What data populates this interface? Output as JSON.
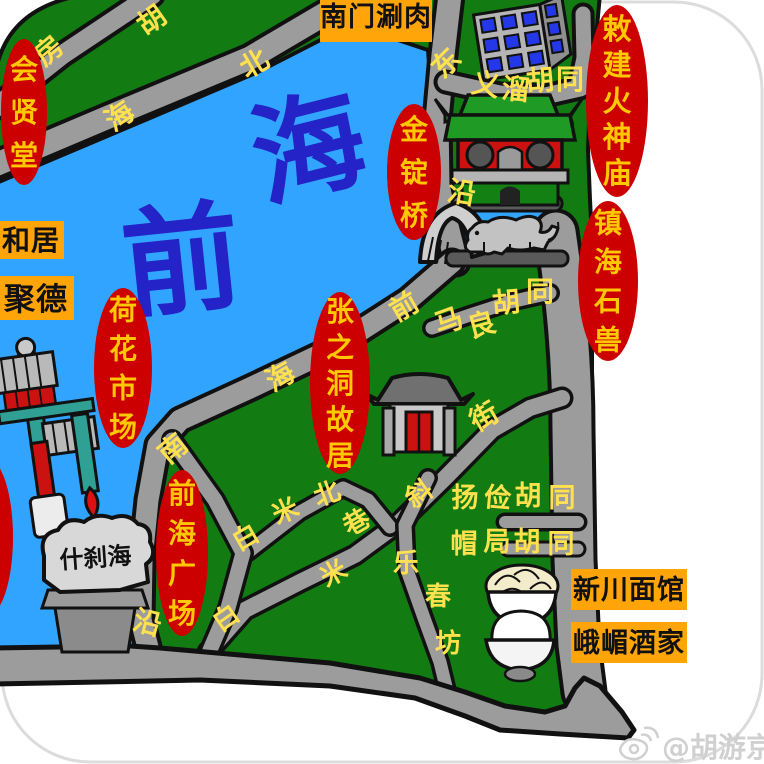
{
  "colors": {
    "lake": "#31a4ff",
    "land": "#127c12",
    "road": "#9c9c9c",
    "outline": "#111111",
    "badge_red": "#cc0000",
    "badge_text": "#ffc800",
    "road_label": "#ffe14e",
    "box_orange": "#ffa50a",
    "box_text": "#111111",
    "lake_text": "#2323c8",
    "watermark": "#d0d0d0"
  },
  "lake_name_chars": [
    {
      "t": "海",
      "x": 318,
      "y": 186,
      "r": -14,
      "s": 112
    },
    {
      "t": "前",
      "x": 186,
      "y": 302,
      "r": -6,
      "s": 118
    }
  ],
  "badges": [
    {
      "name": "huixiantang-badge",
      "label": "会贤堂",
      "cx": 24,
      "cy": 112,
      "rx": 23,
      "ry": 73,
      "s": 28,
      "dy": 43
    },
    {
      "name": "jindingqiao-badge",
      "label": "金锭桥",
      "cx": 414,
      "cy": 172,
      "rx": 27,
      "ry": 68,
      "s": 28,
      "dy": 43
    },
    {
      "name": "huoshenmiao-badge",
      "label": "敕建火神庙",
      "cx": 617,
      "cy": 101,
      "rx": 31,
      "ry": 96,
      "s": 29,
      "dy": 36
    },
    {
      "name": "zhenhaishishou-badge",
      "label": "镇海石兽",
      "cx": 608,
      "cy": 281,
      "rx": 30,
      "ry": 80,
      "s": 28,
      "dy": 39
    },
    {
      "name": "hehuashichang-badge",
      "label": "荷花市场",
      "cx": 123,
      "cy": 368,
      "rx": 29,
      "ry": 80,
      "s": 28,
      "dy": 39
    },
    {
      "name": "zhangzhidong-badge",
      "label": "张之洞故居",
      "cx": 340,
      "cy": 383,
      "rx": 30,
      "ry": 91,
      "s": 28,
      "dy": 36
    },
    {
      "name": "qianhaiguangchang-badge",
      "label": "前海广场",
      "cx": 182,
      "cy": 553,
      "rx": 26,
      "ry": 83,
      "s": 28,
      "dy": 40
    },
    {
      "name": "clipped-left-badge",
      "label": "",
      "cx": -13,
      "cy": 537,
      "rx": 26,
      "ry": 79,
      "s": 26,
      "dy": 38
    }
  ],
  "boxes": [
    {
      "name": "nanmenshuanrou-label",
      "label": "南门涮肉",
      "x": 320,
      "y": -12,
      "w": 112,
      "h": 54,
      "s": 27,
      "tx": 376,
      "ty": 26,
      "anchor": "middle"
    },
    {
      "name": "hejv-label",
      "label": "和居",
      "x": -36,
      "y": 221,
      "w": 100,
      "h": 38,
      "s": 28,
      "tx": 2,
      "ty": 250,
      "anchor": "start"
    },
    {
      "name": "jude-label",
      "label": "聚德",
      "x": -30,
      "y": 276,
      "w": 104,
      "h": 44,
      "s": 31,
      "tx": 4,
      "ty": 310,
      "anchor": "start"
    },
    {
      "name": "xinchuan-noodles-label",
      "label": "新川面馆",
      "x": 571,
      "y": 569,
      "w": 116,
      "h": 41,
      "s": 27,
      "tx": 629,
      "ty": 599,
      "anchor": "middle"
    },
    {
      "name": "emei-restaurant-label",
      "label": "峨嵋酒家",
      "x": 571,
      "y": 622,
      "w": 116,
      "h": 41,
      "s": 27,
      "tx": 629,
      "ty": 652,
      "anchor": "middle"
    }
  ],
  "road_labels": [
    {
      "t": "胡",
      "x": 157,
      "y": 28,
      "r": -35,
      "s": 28
    },
    {
      "t": "房",
      "x": 55,
      "y": 58,
      "r": -40,
      "s": 28
    },
    {
      "t": "北",
      "x": 259,
      "y": 72,
      "r": -30,
      "s": 28
    },
    {
      "t": "海",
      "x": 125,
      "y": 124,
      "r": -35,
      "s": 28
    },
    {
      "t": "东",
      "x": 453,
      "y": 70,
      "r": -45,
      "s": 28
    },
    {
      "t": "义",
      "x": 484,
      "y": 94,
      "r": 10,
      "s": 28
    },
    {
      "t": "溜",
      "x": 515,
      "y": 99,
      "r": 5,
      "s": 28
    },
    {
      "t": "胡",
      "x": 541,
      "y": 90,
      "r": -5,
      "s": 28
    },
    {
      "t": "同",
      "x": 570,
      "y": 89,
      "r": 0,
      "s": 28
    },
    {
      "t": "沿",
      "x": 460,
      "y": 202,
      "r": 10,
      "s": 28
    },
    {
      "t": "前",
      "x": 409,
      "y": 315,
      "r": -30,
      "s": 28
    },
    {
      "t": "海",
      "x": 285,
      "y": 385,
      "r": -30,
      "s": 28
    },
    {
      "t": "马",
      "x": 452,
      "y": 330,
      "r": -20,
      "s": 28
    },
    {
      "t": "良",
      "x": 484,
      "y": 334,
      "r": -15,
      "s": 28
    },
    {
      "t": "胡",
      "x": 507,
      "y": 312,
      "r": -5,
      "s": 28
    },
    {
      "t": "同",
      "x": 540,
      "y": 301,
      "r": 0,
      "s": 28
    },
    {
      "t": "街",
      "x": 489,
      "y": 425,
      "r": -30,
      "s": 28
    },
    {
      "t": "南",
      "x": 179,
      "y": 456,
      "r": -40,
      "s": 28
    },
    {
      "t": "沿",
      "x": 145,
      "y": 632,
      "r": 15,
      "s": 28
    },
    {
      "t": "白",
      "x": 250,
      "y": 545,
      "r": -30,
      "s": 26
    },
    {
      "t": "米",
      "x": 289,
      "y": 519,
      "r": -25,
      "s": 26
    },
    {
      "t": "北",
      "x": 330,
      "y": 502,
      "r": -20,
      "s": 26
    },
    {
      "t": "巷",
      "x": 361,
      "y": 530,
      "r": -30,
      "s": 26
    },
    {
      "t": "白",
      "x": 231,
      "y": 625,
      "r": -35,
      "s": 26
    },
    {
      "t": "米",
      "x": 338,
      "y": 581,
      "r": -30,
      "s": 26
    },
    {
      "t": "斜",
      "x": 424,
      "y": 501,
      "r": -35,
      "s": 26
    },
    {
      "t": "乐",
      "x": 406,
      "y": 572,
      "r": 0,
      "s": 26
    },
    {
      "t": "春",
      "x": 438,
      "y": 605,
      "r": 0,
      "s": 26
    },
    {
      "t": "坊",
      "x": 448,
      "y": 652,
      "r": 0,
      "s": 26
    },
    {
      "t": "扬",
      "x": 465,
      "y": 507,
      "r": 0,
      "s": 27
    },
    {
      "t": "俭",
      "x": 497,
      "y": 507,
      "r": 5,
      "s": 27
    },
    {
      "t": "胡",
      "x": 528,
      "y": 505,
      "r": 0,
      "s": 27
    },
    {
      "t": "同",
      "x": 562,
      "y": 507,
      "r": 0,
      "s": 27
    },
    {
      "t": "帽",
      "x": 464,
      "y": 553,
      "r": 0,
      "s": 27
    },
    {
      "t": "局",
      "x": 497,
      "y": 551,
      "r": 0,
      "s": 27
    },
    {
      "t": "胡",
      "x": 527,
      "y": 551,
      "r": 0,
      "s": 27
    },
    {
      "t": "同",
      "x": 561,
      "y": 553,
      "r": 0,
      "s": 27
    }
  ],
  "rock": {
    "text": "什刹海"
  },
  "watermark": {
    "handle": "@胡游京城"
  }
}
